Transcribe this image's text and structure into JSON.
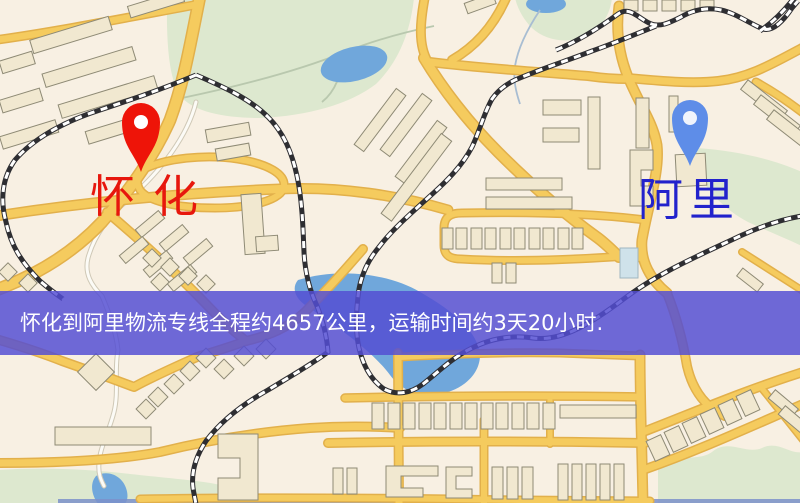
{
  "map_view": {
    "origin": {
      "name": "怀化"
    },
    "destination": {
      "name": "阿里"
    },
    "banner": {
      "text": "怀化到阿里物流专线全程约4657公里，运输时间约3天20小时.",
      "route_name": "怀化到阿里物流专线",
      "total_distance": "约4657公里",
      "transport_time": "约3天20小时"
    }
  },
  "icons": {
    "origin_pin": "red-location-pin-icon",
    "destination_pin": "blue-location-pin-icon"
  },
  "colors": {
    "background": "#f8f0e3",
    "park": "#dde8cf",
    "water": "#70a7db",
    "trail": "#b9c8ae",
    "stream": "#a8bdd2",
    "minor_road": "#fcfbf6",
    "road_fill": "#f5cb5e",
    "road_casing": "#e2b04b",
    "building_fill": "#f1e8d0",
    "building_stroke": "#8e8a75",
    "rail_dark": "#2e2e32",
    "rail_light": "#ffffff",
    "banner_bg": "rgba(84,78,211,0.84)",
    "banner_text": "#ffffff",
    "origin_pin": "#ee1408",
    "origin_label": "#e7170d",
    "destination_pin": "#5e8de8",
    "destination_label": "#2222cc"
  }
}
